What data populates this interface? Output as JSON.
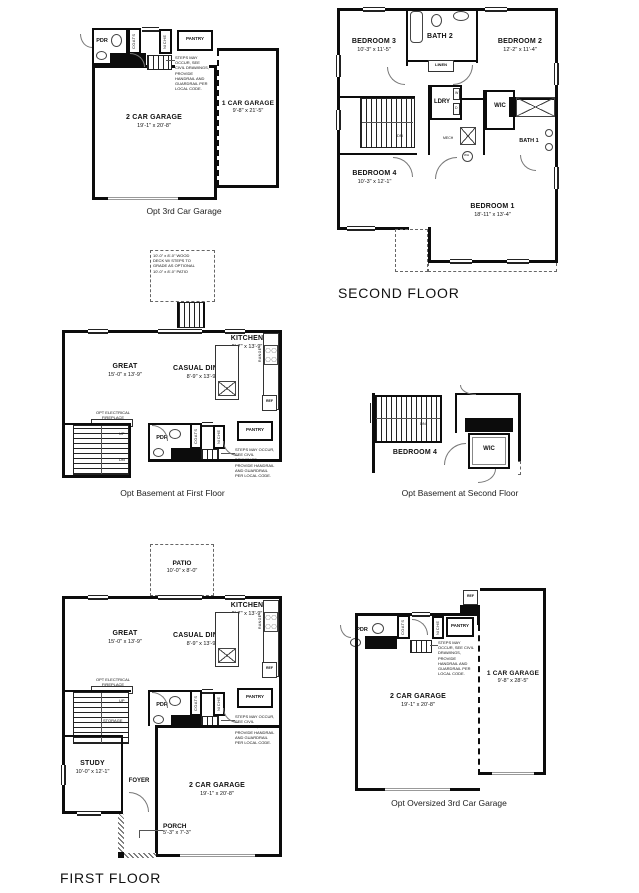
{
  "sheet_title": "Floor plan sheet",
  "plans": {
    "opt3": {
      "caption": "Opt 3rd Car Garage",
      "pdr": "PDR",
      "coats": "COATS",
      "niche": "NICHE",
      "pantry": "PANTRY",
      "garage2": {
        "name": "2 CAR GARAGE",
        "dims": "19'-1\" x 20'-8\""
      },
      "garage1": {
        "name": "1 CAR GARAGE",
        "dims": "9'-8\" x 21'-5\""
      },
      "note": "STEPS MAY OCCUR, SEE CIVIL DRAWINGS, PROVIDE HANDRAIL AND GUARDRAIL PER LOCAL CODE."
    },
    "second": {
      "caption": "SECOND FLOOR",
      "bedroom3": {
        "name": "BEDROOM 3",
        "dims": "10'-3\" x 11'-5\""
      },
      "bath2": "BATH 2",
      "bedroom2": {
        "name": "BEDROOM 2",
        "dims": "12'-2\" x 11'-4\""
      },
      "linen": "LINEN",
      "ldry": "LDRY",
      "washer": "W",
      "dryer": "D",
      "wic": "WIC",
      "bath1": "BATH 1",
      "mech": "MECH",
      "wh": "WH",
      "dn": "DN",
      "bedroom4": {
        "name": "BEDROOM 4",
        "dims": "10'-3\" x 12'-1\""
      },
      "bedroom1": {
        "name": "BEDROOM 1",
        "dims": "18'-11\" x 13'-4\""
      }
    },
    "bsmt1": {
      "caption": "Opt Basement at First Floor",
      "deck_note": "10'-0\" x 8'-0\" WOOD DECK W/ STEPS TO GRADE AS OPTIONAL 10'-0\" x 8'-0\" PATIO",
      "kitchen": {
        "name": "KITCHEN",
        "dims": "9'-7\" x 13'-9\""
      },
      "great": {
        "name": "GREAT",
        "dims": "15'-0\" x 13'-9\""
      },
      "dining": {
        "name": "CASUAL DINING",
        "dims": "8'-9\" x 13'-9\""
      },
      "fireplace": "OPT ELECTRICAL FIREPLACE",
      "range": "RANGE",
      "ref": "REF",
      "pdr": "PDR",
      "coats": "COATS",
      "niche": "NICHE",
      "pantry": "PANTRY",
      "up": "UP",
      "dn": "DN",
      "note": "STEPS MAY OCCUR, SEE CIVIL DRAWINGS, PROVIDE HANDRAIL AND GUARDRAIL PER LOCAL CODE."
    },
    "bsmt2": {
      "caption": "Opt Basement at Second Floor",
      "bedroom4": "BEDROOM 4",
      "wic": "WIC",
      "dn": "DN"
    },
    "first": {
      "caption": "FIRST FLOOR",
      "patio": {
        "name": "PATIO",
        "dims": "10'-0\" x 8'-0\""
      },
      "kitchen": {
        "name": "KITCHEN",
        "dims": "9'-7\" x 13'-9\""
      },
      "great": {
        "name": "GREAT",
        "dims": "15'-0\" x 13'-9\""
      },
      "dining": {
        "name": "CASUAL DINING",
        "dims": "8'-9\" x 13'-9\""
      },
      "fireplace": "OPT ELECTRICAL FIREPLACE",
      "range": "RANGE",
      "ref": "REF",
      "pdr": "PDR",
      "coats": "COATS",
      "niche": "NICHE",
      "pantry": "PANTRY",
      "up": "UP",
      "storage": "STORAGE",
      "study": {
        "name": "STUDY",
        "dims": "10'-0\" x 12'-1\""
      },
      "foyer": "FOYER",
      "garage2": {
        "name": "2 CAR GARAGE",
        "dims": "19'-1\" x 20'-8\""
      },
      "porch": {
        "name": "PORCH",
        "dims": "5'-3\" x 7'-3\""
      },
      "note": "STEPS MAY OCCUR, SEE CIVIL DRAWINGS, PROVIDE HANDRAIL AND GUARDRAIL PER LOCAL CODE."
    },
    "optbig": {
      "caption": "Opt Oversized 3rd Car Garage",
      "ref": "REF",
      "pdr": "PDR",
      "coats": "COATS",
      "niche": "NICHE",
      "pantry": "PANTRY",
      "garage2": {
        "name": "2 CAR GARAGE",
        "dims": "19'-1\" x 20'-8\""
      },
      "garage1": {
        "name": "1 CAR GARAGE",
        "dims": "9'-8\" x 28'-5\""
      },
      "note": "STEPS MAY OCCUR, SEE CIVIL DRAWINGS, PROVIDE HANDRAIL AND GUARDRAIL PER LOCAL CODE."
    }
  }
}
